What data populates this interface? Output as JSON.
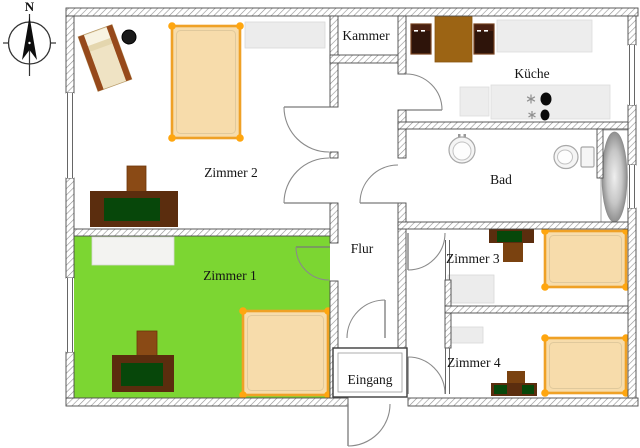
{
  "compass": {
    "north_label": "N"
  },
  "rooms": {
    "zimmer1": {
      "label": "Zimmer 1"
    },
    "zimmer2": {
      "label": "Zimmer 2"
    },
    "zimmer3": {
      "label": "Zimmer 3"
    },
    "zimmer4": {
      "label": "Zimmer 4"
    },
    "kammer": {
      "label": "Kammer"
    },
    "flur": {
      "label": "Flur"
    },
    "eingang": {
      "label": "Eingang"
    },
    "kueche": {
      "label": "Küche"
    },
    "bad": {
      "label": "Bad"
    }
  },
  "colors": {
    "zimmer1_floor": "#7cd632",
    "bed_fill": "#f7dcab",
    "bed_frame": "#efa126",
    "bed_corner": "#ffa60f",
    "desk_body": "#5b2d0e",
    "desk_surface": "#07470a",
    "chair": "#8a4a15",
    "kitchen_table": "#9c6414",
    "kitchen_chair": "#2e140a",
    "lounger_frame": "#96491b",
    "lounger_cushion": "#efe3c4",
    "wardrobe": "#ececec",
    "burner": "#0a0a0a",
    "side_table": "#1a1a1a"
  }
}
